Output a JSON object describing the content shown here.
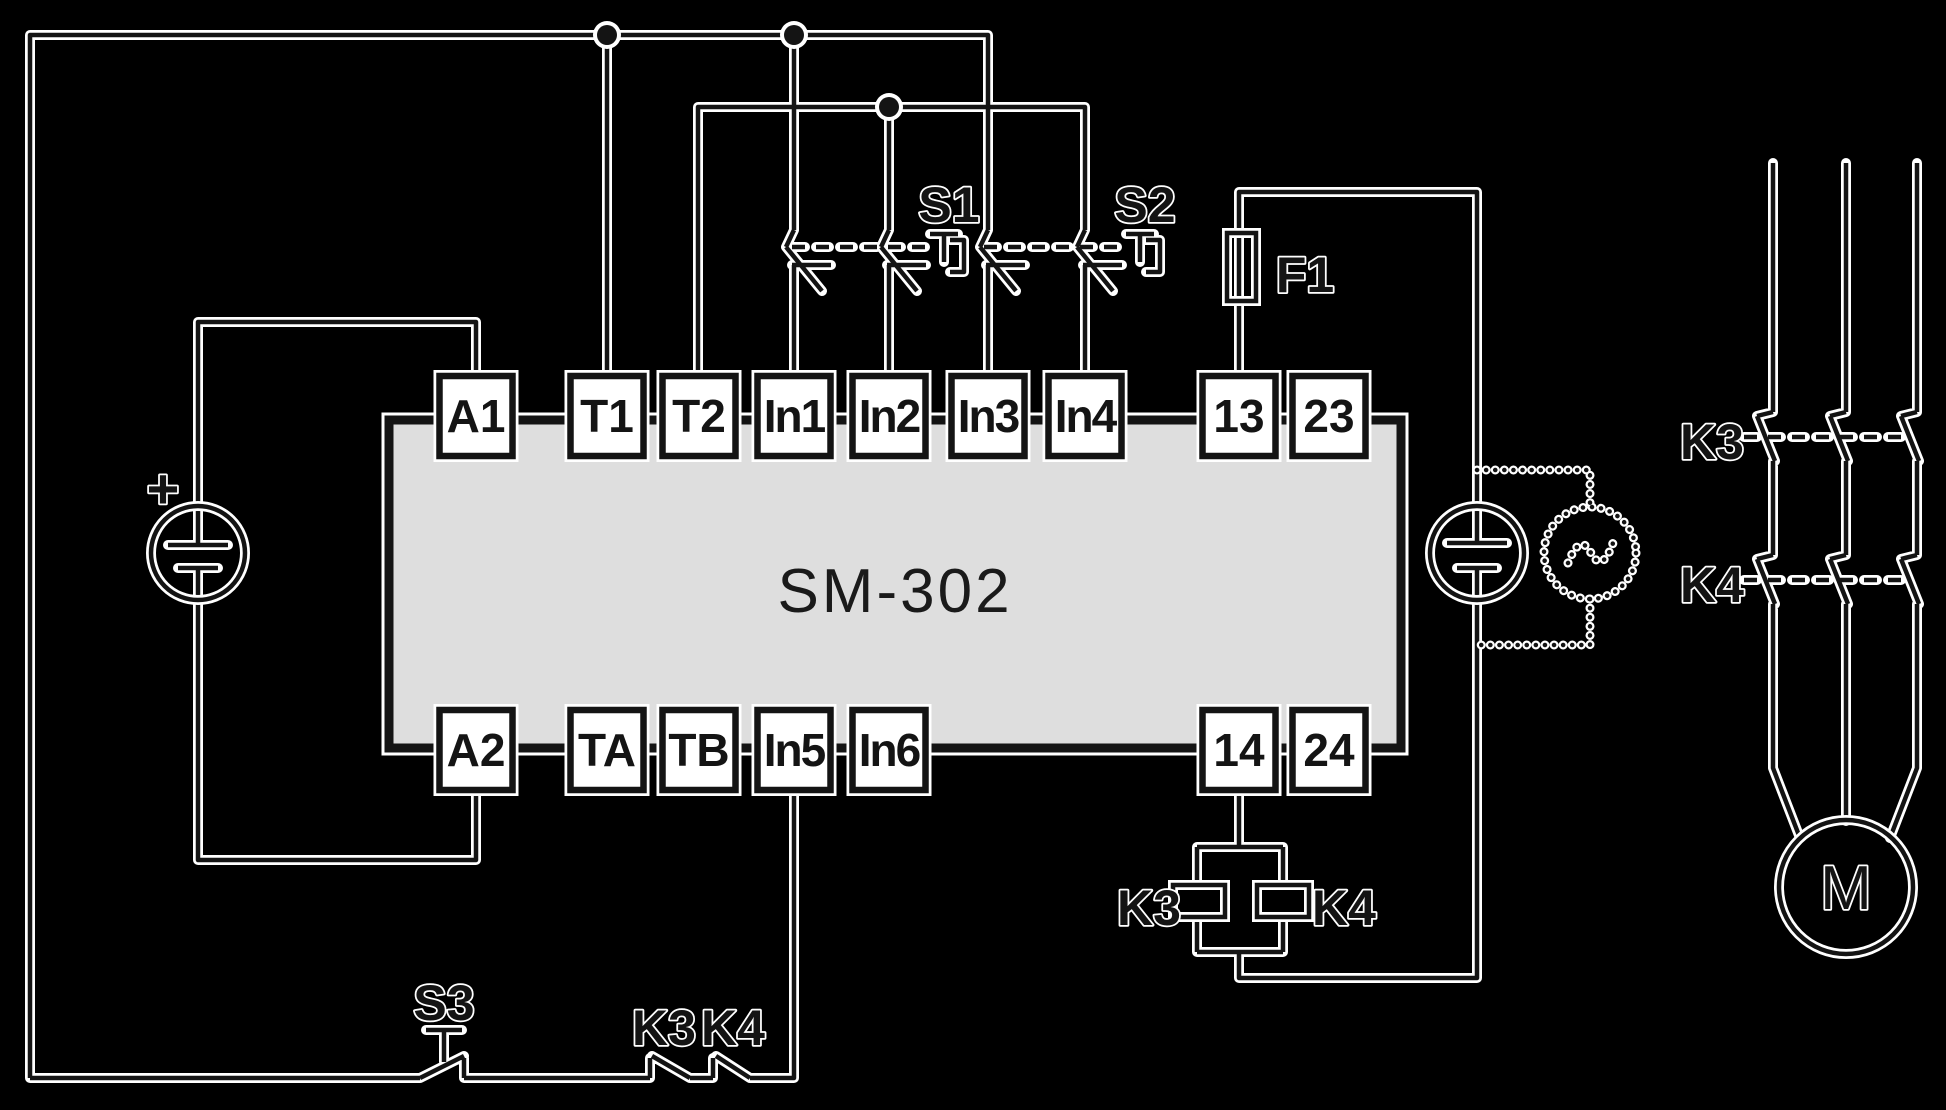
{
  "module": {
    "title": "SM-302"
  },
  "terminals": {
    "top": [
      "A1",
      "T1",
      "T2",
      "In1",
      "In2",
      "In3",
      "In4",
      "13",
      "23"
    ],
    "bottom": [
      "A2",
      "TA",
      "TB",
      "In5",
      "In6",
      "14",
      "24"
    ]
  },
  "labels": {
    "s1": "S1",
    "s2": "S2",
    "s3": "S3",
    "f1": "F1",
    "k3_main": "K3",
    "k4_main": "K4",
    "k3_coil": "K3",
    "k4_coil": "K4",
    "k3_aux": "K3",
    "k4_aux": "K4",
    "motor": "M",
    "dc_plus": "+",
    "ac_tilde": "~"
  },
  "colors": {
    "background": "#000000",
    "line": "#141414",
    "halo": "#ffffff",
    "module_fill": "#dedede",
    "terminal_fill": "#ffffff"
  }
}
